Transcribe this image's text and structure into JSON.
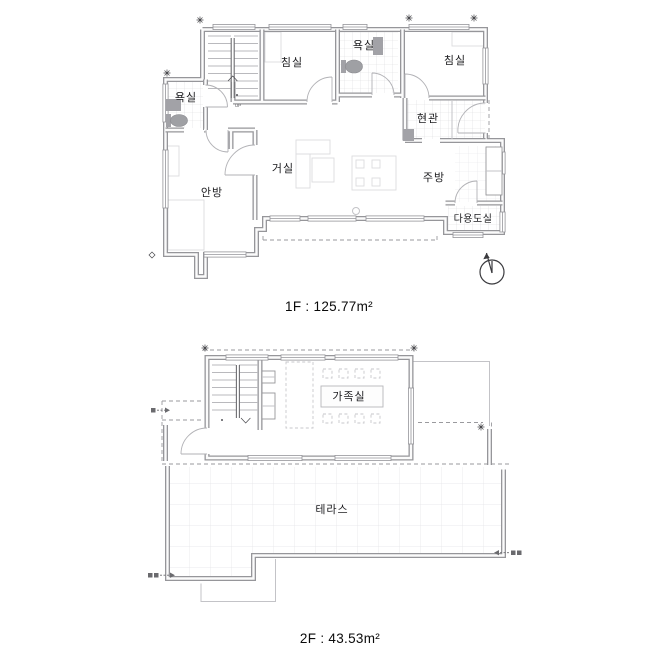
{
  "floor1": {
    "caption": "1F : 125.77m²",
    "rooms": {
      "bedroom1": "침실",
      "bath_top": "욕실",
      "bedroom2": "침실",
      "bath_left": "욕실",
      "entrance": "현관",
      "living": "거실",
      "master": "안방",
      "kitchen": "주방",
      "utility": "다용도실"
    },
    "stairs_direction": "UP"
  },
  "floor2": {
    "caption": "2F : 43.53m²",
    "rooms": {
      "family": "가족실",
      "terrace": "테라스"
    }
  },
  "colors": {
    "wall": "#96969a",
    "dash": "#9a9a9e",
    "tile": "#dcdcdf",
    "text": "#1c1c1f"
  }
}
